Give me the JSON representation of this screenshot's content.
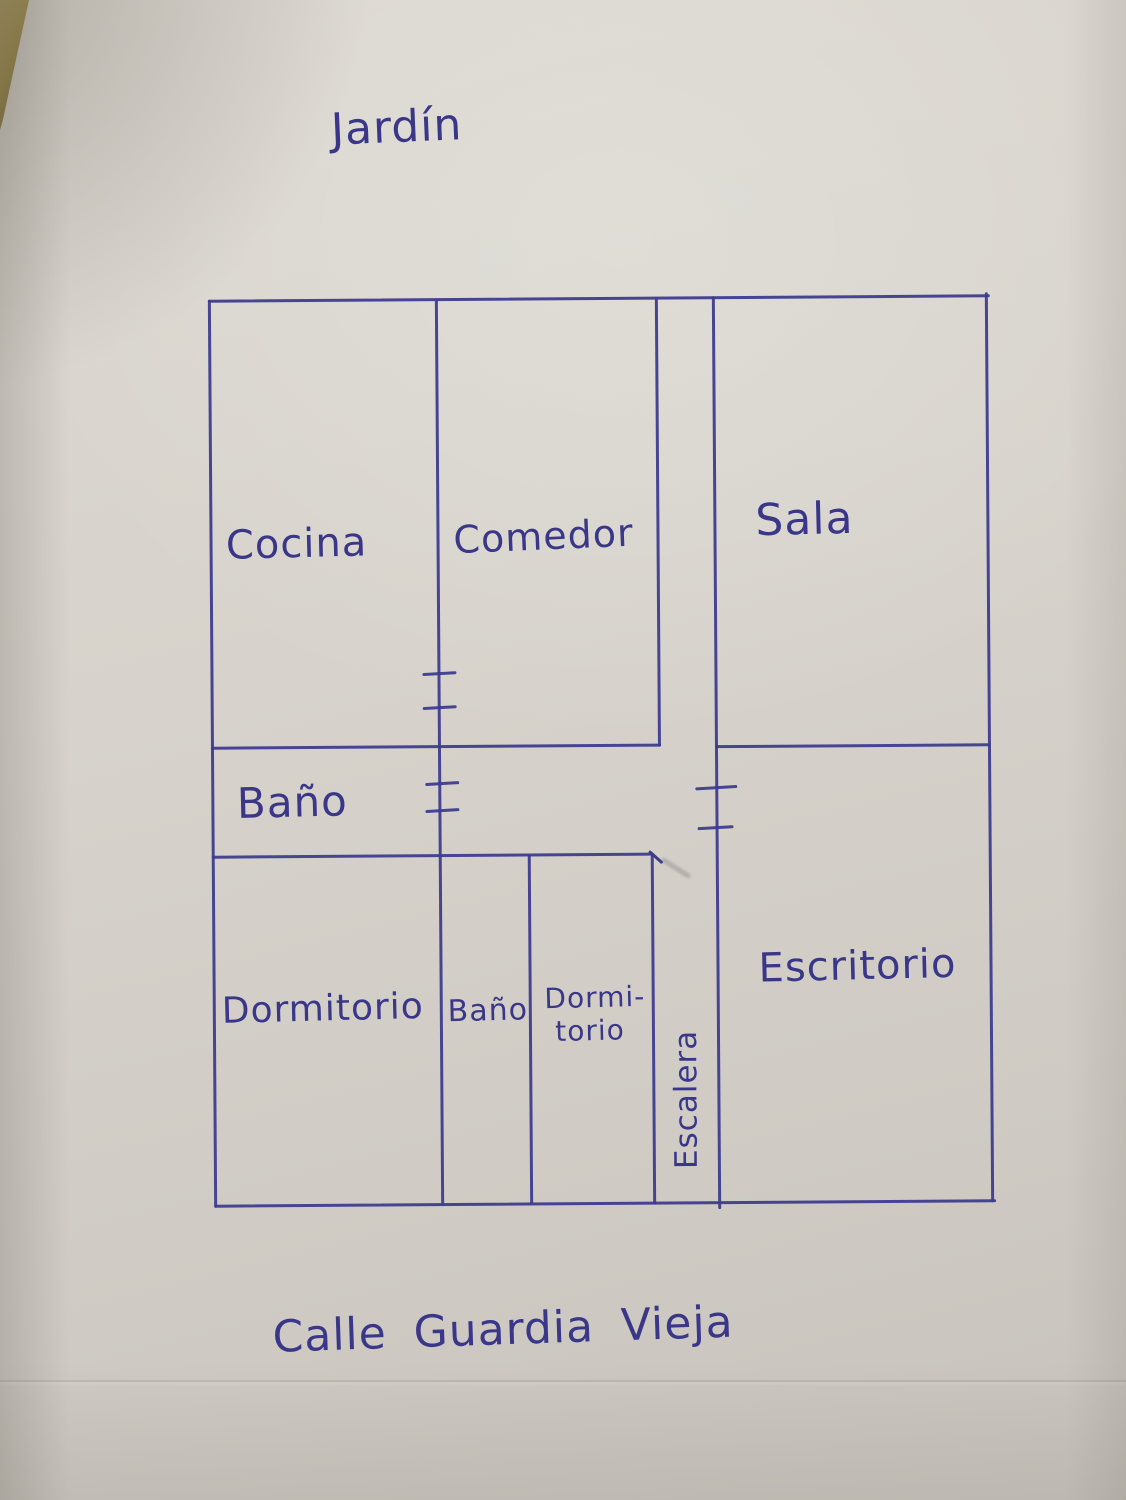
{
  "plan": {
    "area_top_label": "Jardín",
    "street_bottom_label": "Calle Guardia Vieja",
    "rooms": {
      "cocina": "Cocina",
      "comedor": "Comedor",
      "sala": "Sala",
      "bano_superior": "Baño",
      "dormitorio_principal": "Dormitorio",
      "bano_inferior": "Baño",
      "dormitorio_secundario_l1": "Dormi-",
      "dormitorio_secundario_l2": "torio",
      "escalera": "Escalera",
      "escritorio": "Escritorio"
    },
    "colors": {
      "ink": "#3e3b8e",
      "paper": "#d6d2ca"
    }
  }
}
